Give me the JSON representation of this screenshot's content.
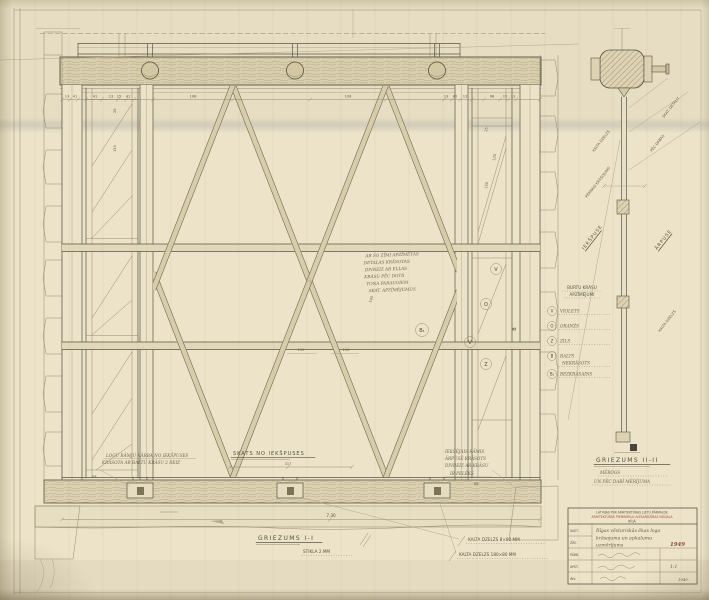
{
  "colors": {
    "paper": "#ece3c8",
    "ink": "#5b5545",
    "red": "#a84a3c",
    "timber": "#d9cfad"
  },
  "elevation": {
    "top_dims": [
      "13",
      "41",
      "41",
      "13",
      "15",
      "41",
      "108",
      "108",
      "13",
      "41",
      "13",
      "98",
      "15",
      "13"
    ],
    "mid_dims": [
      "119",
      "110"
    ],
    "diag_dim": "140",
    "pilaster_dims": [
      "25",
      "120",
      "150"
    ],
    "lp_dims": [
      "25",
      "150"
    ],
    "span": "7.30",
    "view_note": {
      "title": "SKATS NO IEKŠPUSES",
      "dim": "317"
    },
    "left_note": {
      "lines": [
        "LOGU RĀMJU KĀRBA NO IEKŠPUSES",
        "KRĀSOTA AR BALTU KRĀSU 2 REIZ"
      ],
      "dim": "88"
    },
    "right_note": {
      "lines": [
        "IEKŠĒJAIS RĀMIS",
        "ĀRPUSĒ KRĀSOTS",
        "DIVREIZ AR KRĀSU",
        "IR PELĒKS"
      ],
      "dim": "88"
    },
    "note_lines": [
      "AR ŠO ZĪMI APZĪMĒTĀS",
      "DETAĻAS KRĀSOTAS",
      "DIVREIZ AR EĻĻAS",
      "KRĀSU PĒC DOTĀ",
      "TOŅA PARAUGIEM",
      "SKAT. APZĪMĒJUMUS"
    ],
    "markers": {
      "b1": "B₁",
      "v1": "V",
      "o": "O",
      "v2": "V",
      "z": "Z",
      "b": "B"
    }
  },
  "footer": {
    "section1": "GRIEZUMS I-I",
    "section1_sub": "STIKLA 2 MM",
    "iron1": "KALTA DZELZS 8×80 MM",
    "iron2": "KALTA DZELZS 180×80 MM"
  },
  "legend": {
    "title1": "BURTU KRĀSU",
    "title2": "APZĪMĒJUMI",
    "items": [
      {
        "key": "V",
        "label": "VIOLETS"
      },
      {
        "key": "O",
        "label": "ORANŽS"
      },
      {
        "key": "Z",
        "label": "ZILS"
      },
      {
        "key": "B",
        "label": "BALTS",
        "label2": "NEKRĀSOTS"
      },
      {
        "key": "B₁",
        "label": "BEZKRĀSAINS"
      }
    ]
  },
  "section2": {
    "title": "GRIEZUMS II-II",
    "sub1": "MĒROGS",
    "sub2": "UN PĒC DABĪ MĒRĪJUMA",
    "labels": {
      "l1": "KALTA DZELZS",
      "l2": "PĒRNAIS KRĀSOJUMS",
      "inside": "IEKŠPUSE",
      "r1": "SKAT. DETAĻU",
      "r2": "PĒC DABAS",
      "outside": "ĀRPUSE",
      "r3": "KALTA DZELZS"
    }
  },
  "titleblock": {
    "printed1": "LATVIJAS PSR ARHITEKTŪRAS LIETU PĀRVALDE",
    "printed2": "ARHITEKTŪRAS PIEMINEKĻU AIZSARDZĪBAS NODAĻA",
    "printed3": "RĪGĀ",
    "col_labels": [
      "SAST.",
      "ZĪM.",
      "PĀRB.",
      "APST.",
      "INV."
    ],
    "desc": [
      "Rīgas vēsturiskās ēkas loga",
      "krāsojuma un apkalumu",
      "uzmērījums"
    ],
    "year": "1949",
    "scale": "1:1",
    "year2": "1949."
  }
}
